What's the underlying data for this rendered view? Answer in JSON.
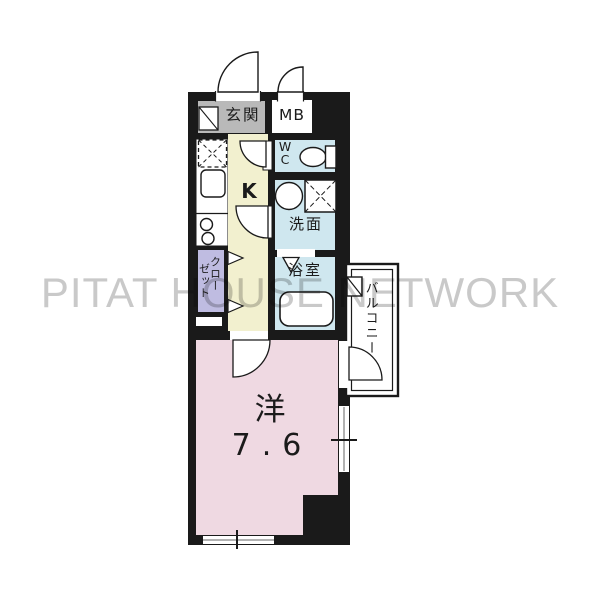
{
  "watermark": {
    "text": "PITAT HOUSE NETWORK"
  },
  "floorplan": {
    "entrance": {
      "label": "玄関"
    },
    "meter_box": {
      "label": "MB"
    },
    "toilet": {
      "line1": "W",
      "line2": "C"
    },
    "kitchen": {
      "label": "K"
    },
    "washroom": {
      "label": "洗面"
    },
    "bathroom": {
      "label": "浴室"
    },
    "closet": {
      "column_right": "クロー",
      "column_left": "ゼット"
    },
    "balcony": {
      "label": "バルコニー"
    },
    "western_room": {
      "kanji": "洋",
      "size": "7.6"
    }
  },
  "colors": {
    "wall": "#1a1a1a",
    "entrance_fill": "#b9b9b9",
    "kitchen_fill": "#f2f0cf",
    "wet_area_fill": "#cfe7ef",
    "closet_fill": "#bfbce1",
    "room_fill": "#efd9e2",
    "watermark": "#c9c9c9"
  }
}
